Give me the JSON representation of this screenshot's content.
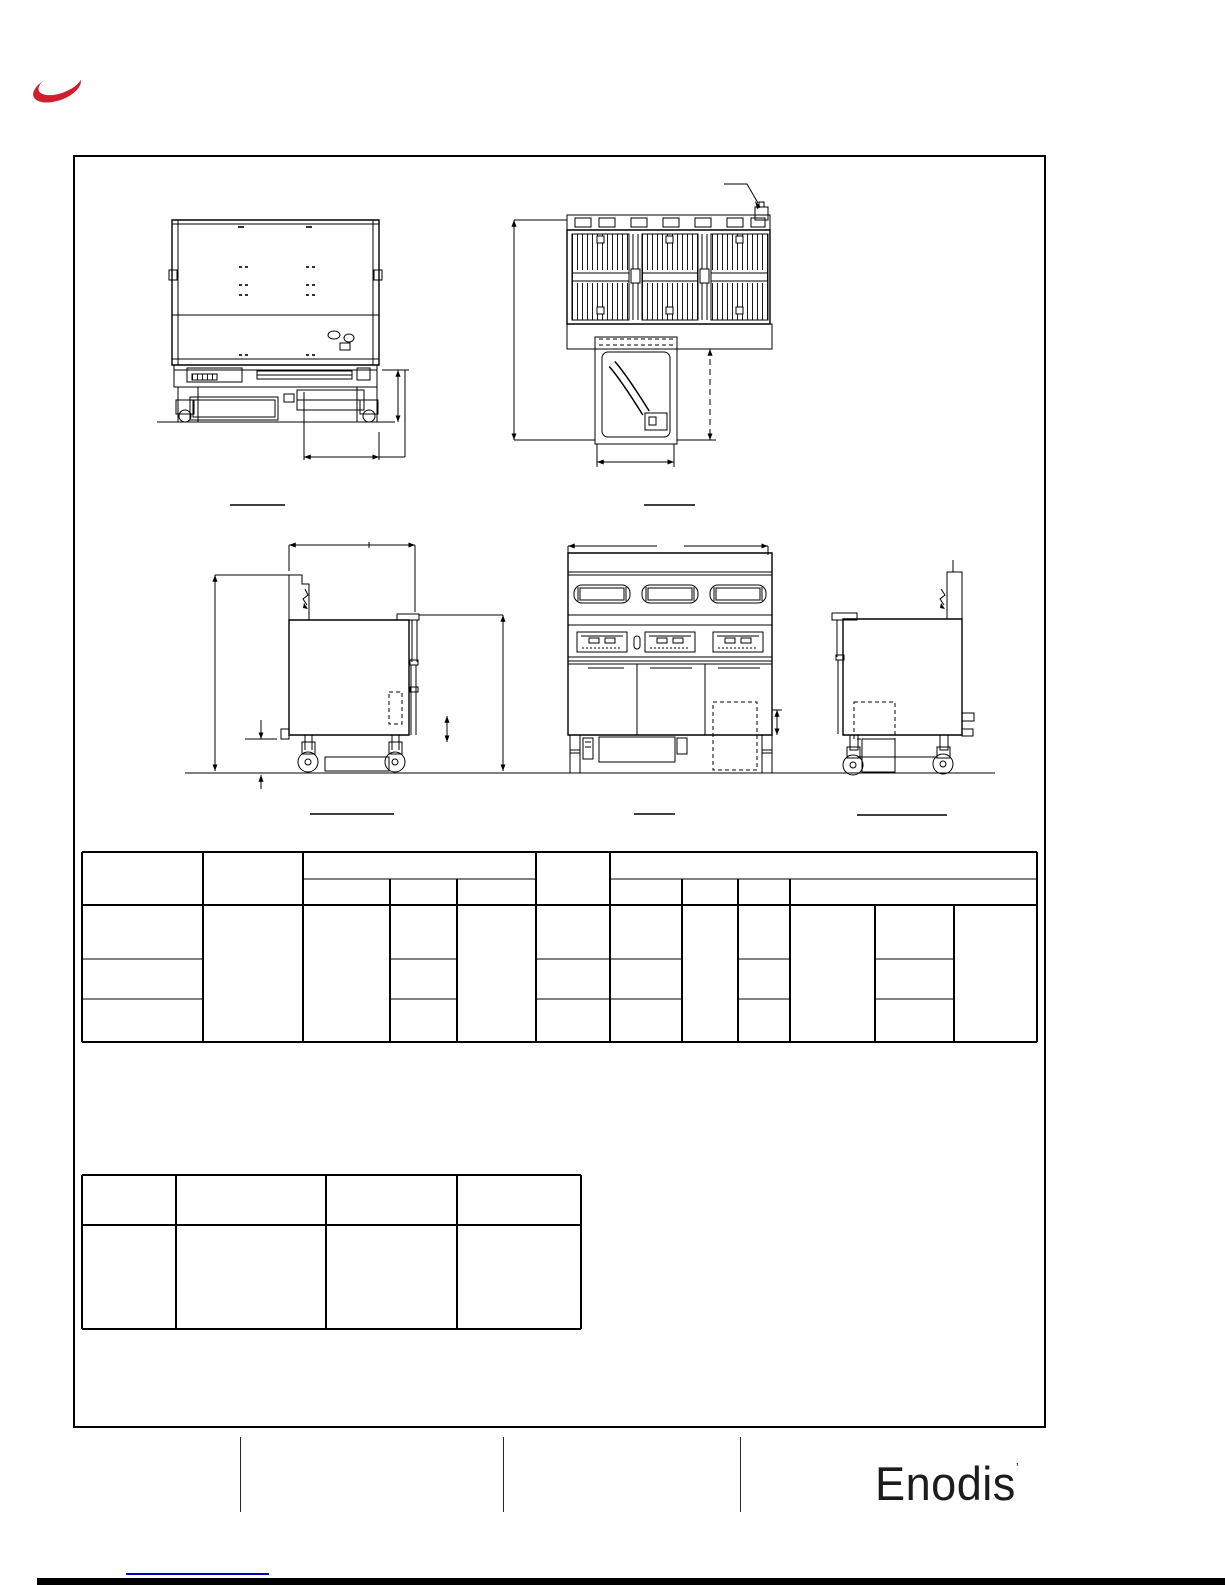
{
  "colors": {
    "accent_red": "#CE1F2D",
    "link_blue": "#0000C3",
    "drawing_ink": "#000000"
  },
  "brand": {
    "footer_logo_text": "Enodis",
    "footer_logo_mark": "’"
  }
}
